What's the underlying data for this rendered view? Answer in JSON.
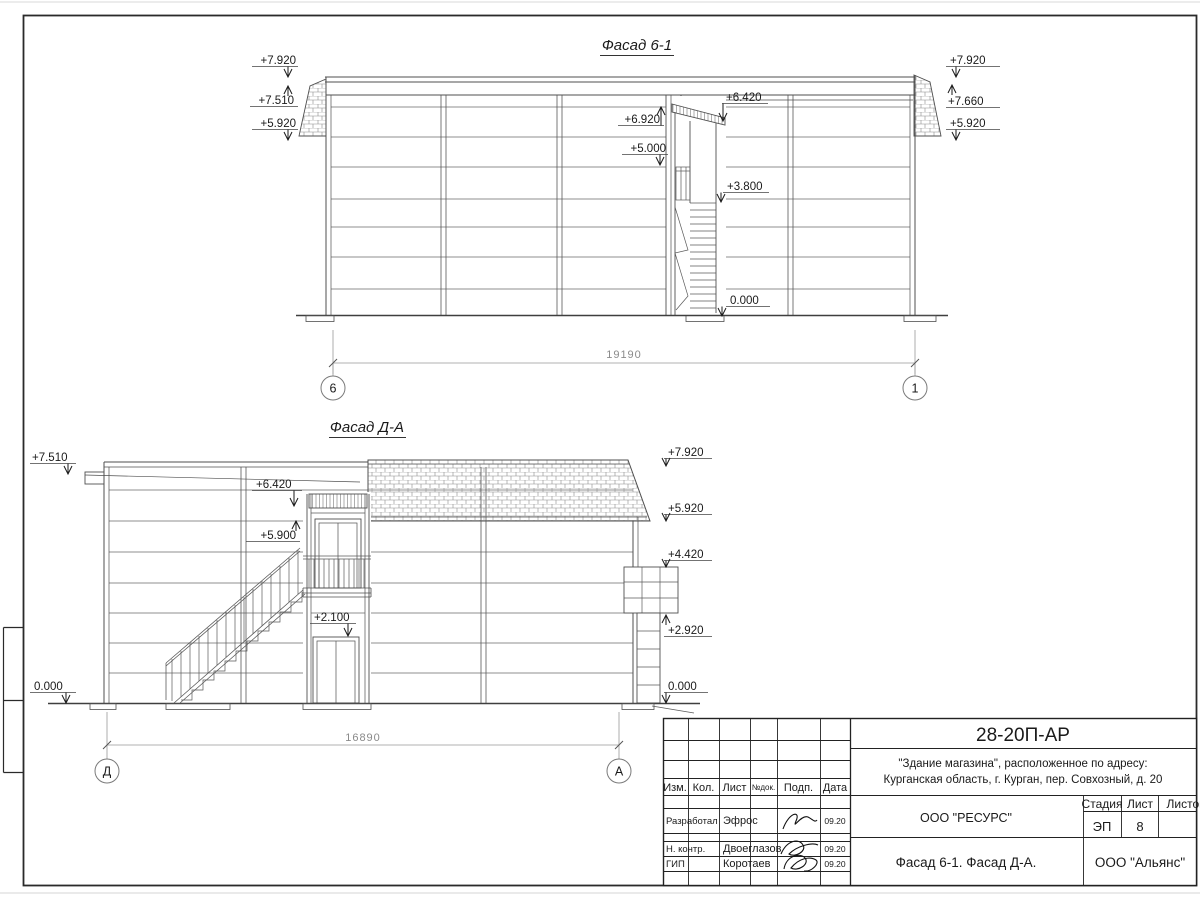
{
  "f1": {
    "title": "Фасад 6-1",
    "dim": "19190",
    "ax1": "6",
    "ax2": "1",
    "left": [
      "+7.920",
      "+7.510",
      "+5.920"
    ],
    "right": [
      "+7.920",
      "+7.660",
      "+5.920"
    ],
    "mid": [
      "+6.920",
      "+5.000",
      "+6.420",
      "+3.800",
      "0.000"
    ]
  },
  "f2": {
    "title": "Фасад Д-А",
    "dim": "16890",
    "ax1": "Д",
    "ax2": "А",
    "left": [
      "+7.510",
      "0.000"
    ],
    "mid": [
      "+6.420",
      "+5.900",
      "+2.100"
    ],
    "right": [
      "+7.920",
      "+5.920",
      "+4.420",
      "+2.920",
      "0.000"
    ]
  },
  "tb": {
    "code": "28-20П-АР",
    "project_line1": "\"Здание магазина\", расположенное по адресу:",
    "project_line2": "Курганская область, г. Курган, пер. Совхозный, д. 20",
    "org_top": "ООО \"РЕСУРС\"",
    "sheet_name": "Фасад 6-1. Фасад Д-А.",
    "org_bottom": "ООО \"Альянс\"",
    "stage_label": "Стадия",
    "stage_value": "ЭП",
    "sheet_label": "Лист",
    "sheet_value": "8",
    "sheets_label": "Листов",
    "col1": "Изм.",
    "col2": "Кол.",
    "col3": "Лист",
    "col4": "№док.",
    "col5": "Подп.",
    "col6": "Дата",
    "row1_role": "Разработал",
    "row1_name": "Эфрос",
    "row1_date": "09.20",
    "row2_role": "Н. контр.",
    "row2_name": "Двоеглазов",
    "row2_date": "09.20",
    "row3_role": "ГИП",
    "row3_name": "Коротаев",
    "row3_date": "09.20"
  }
}
